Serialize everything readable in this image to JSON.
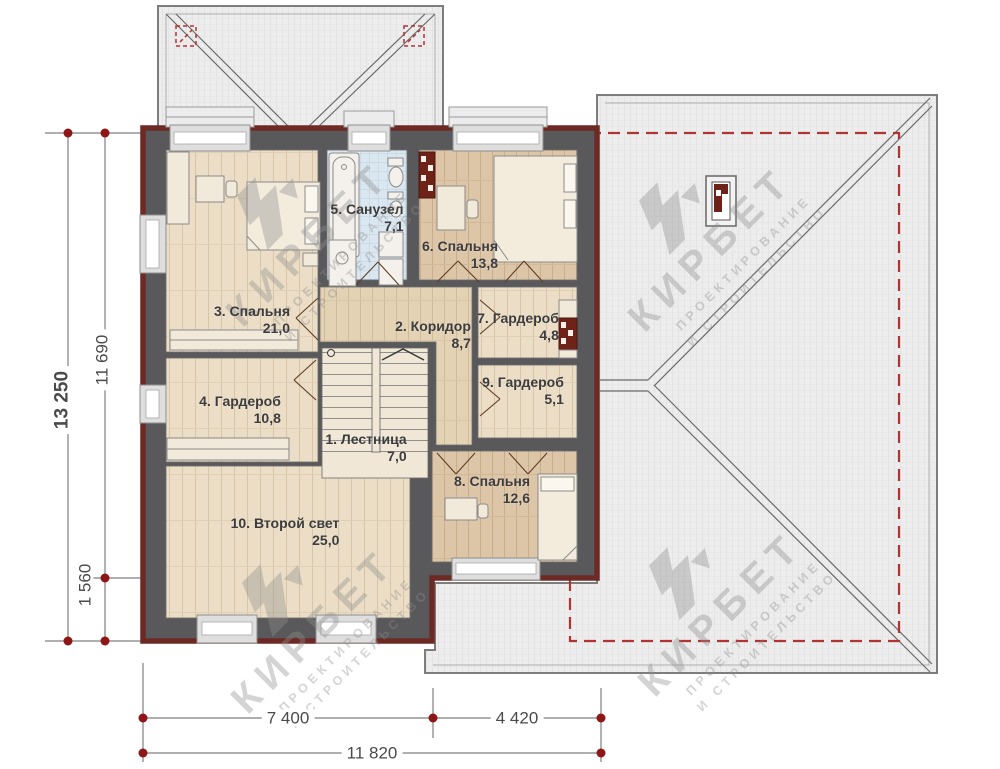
{
  "watermark": {
    "brand": "КИРБЕТ",
    "tagline1": "ПРОЕКТИРОВАНИЕ",
    "tagline2": "И СТРОИТЕЛЬСТВО"
  },
  "rooms": [
    {
      "id": 1,
      "label": "1. Лестница",
      "area": "7,0"
    },
    {
      "id": 2,
      "label": "2. Коридор",
      "area": "8,7"
    },
    {
      "id": 3,
      "label": "3. Спальня",
      "area": "21,0"
    },
    {
      "id": 4,
      "label": "4. Гардероб",
      "area": "10,8"
    },
    {
      "id": 5,
      "label": "5. Санузел",
      "area": "7,1"
    },
    {
      "id": 6,
      "label": "6. Спальня",
      "area": "13,8"
    },
    {
      "id": 7,
      "label": "7. Гардероб",
      "area": "4,8"
    },
    {
      "id": 8,
      "label": "8. Спальня",
      "area": "12,6"
    },
    {
      "id": 9,
      "label": "9. Гардероб",
      "area": "5,1"
    },
    {
      "id": 10,
      "label": "10. Второй свет",
      "area": "25,0"
    }
  ],
  "dimensions": {
    "left_outer": "13 250",
    "left_inner": "11 690",
    "left_lower": "1 560",
    "bottom_left": "7 400",
    "bottom_right": "4 420",
    "bottom_total": "11 820"
  },
  "colors": {
    "wall_fill": "#59595b",
    "wall_trim": "#6d2a25",
    "dashed_red": "#b13434",
    "marker_red": "#8e1616",
    "wood_light": "#ebddc6",
    "wood_tan": "#ddc6a8",
    "tile_blue": "#dbe7f0",
    "roof_gray": "#ededed"
  }
}
